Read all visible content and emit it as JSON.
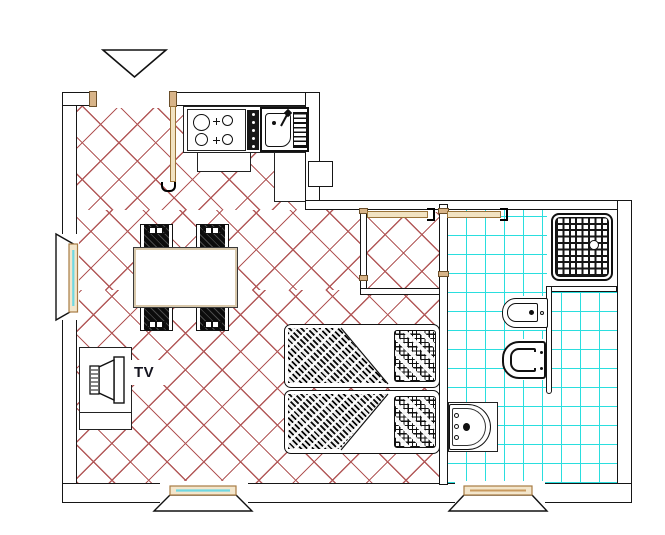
{
  "plan": {
    "title": "apartment floor plan",
    "labels": {
      "tv": "TV"
    },
    "rooms": [
      {
        "name": "living-dining",
        "floor": "red-diagonal-hatch"
      },
      {
        "name": "kitchen",
        "floor": "red-diagonal-hatch"
      },
      {
        "name": "sleeping-area",
        "floor": "red-diagonal-hatch"
      },
      {
        "name": "hallway-closet",
        "floor": "red-diagonal-hatch"
      },
      {
        "name": "bathroom",
        "floor": "cyan-tile-grid"
      }
    ],
    "fixtures": [
      "entrance-marker-triangle",
      "entry-door",
      "cooktop-4-burners",
      "kitchen-sink-with-drainer",
      "dining-table",
      "chair-x4",
      "tv-cabinet",
      "double-bed",
      "shower-tray",
      "bidet",
      "toilet",
      "washbasin",
      "window-left",
      "window-bottom-living",
      "window-bottom-bath",
      "door-leaf-hall",
      "door-leaf-bath"
    ],
    "colors": {
      "walls": "#161616",
      "floor_hatch": "#b25858",
      "bathroom_tile": "#2adede",
      "wood_tan": "#d8b488",
      "glass_cyan": "#6fd8e2",
      "background": "#ffffff"
    }
  }
}
